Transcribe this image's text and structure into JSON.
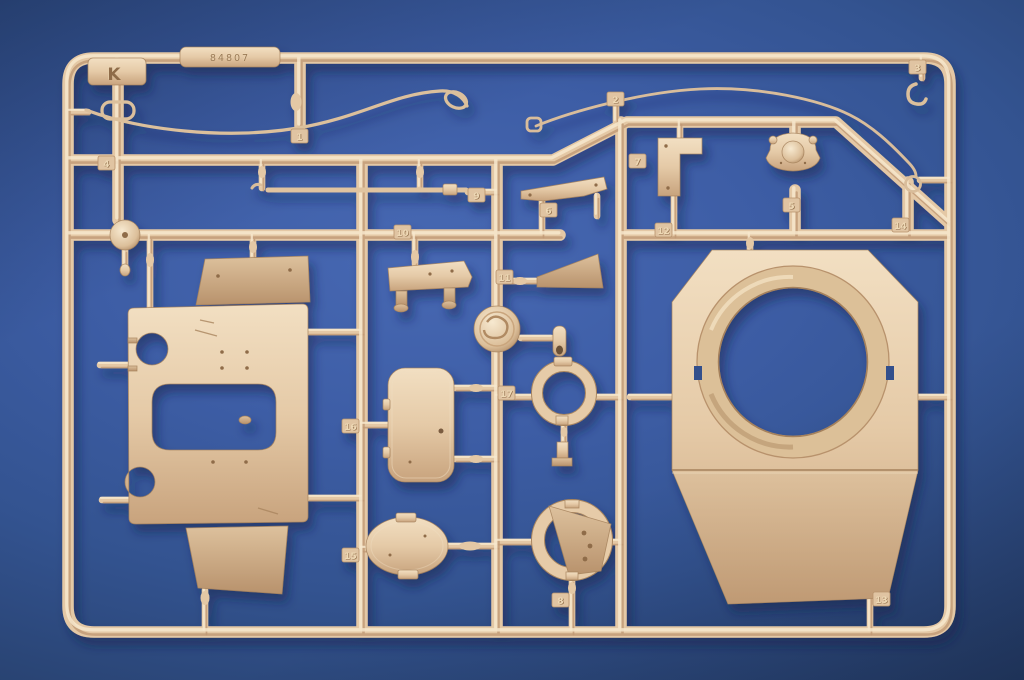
{
  "scene_description": "Tan plastic model-kit parts sprue photographed on a blue background",
  "sprue": {
    "letter": "K",
    "embossed_code": "84807",
    "tags": [
      {
        "label": "1",
        "x": 291,
        "y": 129
      },
      {
        "label": "2",
        "x": 607,
        "y": 92
      },
      {
        "label": "3",
        "x": 909,
        "y": 60
      },
      {
        "label": "4",
        "x": 98,
        "y": 156
      },
      {
        "label": "5",
        "x": 783,
        "y": 198
      },
      {
        "label": "6",
        "x": 540,
        "y": 203
      },
      {
        "label": "7",
        "x": 629,
        "y": 154
      },
      {
        "label": "8",
        "x": 552,
        "y": 593
      },
      {
        "label": "9",
        "x": 468,
        "y": 188
      },
      {
        "label": "10",
        "x": 394,
        "y": 225
      },
      {
        "label": "11",
        "x": 496,
        "y": 270
      },
      {
        "label": "12",
        "x": 655,
        "y": 223
      },
      {
        "label": "13",
        "x": 873,
        "y": 592
      },
      {
        "label": "14",
        "x": 892,
        "y": 218
      },
      {
        "label": "15",
        "x": 342,
        "y": 548
      },
      {
        "label": "16",
        "x": 342,
        "y": 419
      },
      {
        "label": "17",
        "x": 498,
        "y": 386
      }
    ]
  },
  "colors": {
    "plastic": "#e4c8a5",
    "plastic_highlight": "#f7e8cc",
    "plastic_shadow": "#bf9974",
    "plastic_deep": "#8f6c48",
    "background": "#335390",
    "background_dark": "#1d3156",
    "cast_shadow": "#0e2148"
  }
}
